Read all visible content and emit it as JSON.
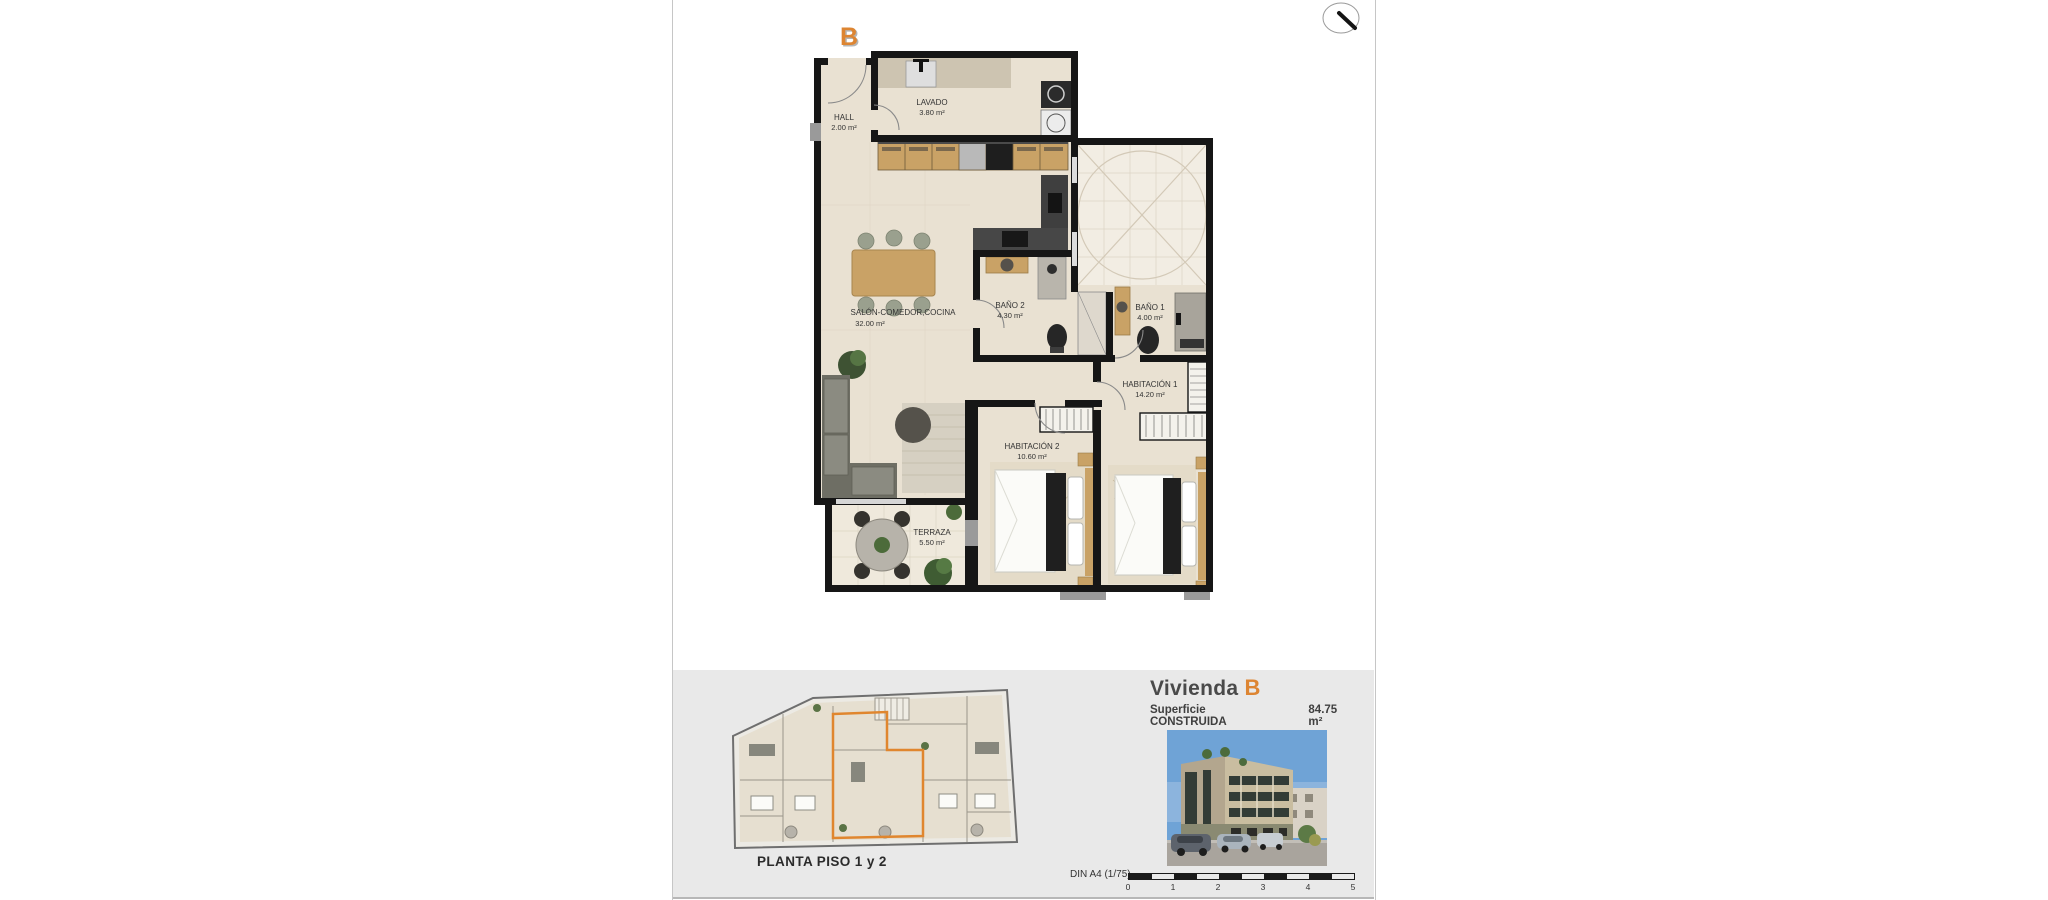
{
  "unit": {
    "letter": "B"
  },
  "header": {
    "title_prefix": "Vivienda",
    "surface_label": "Superficie CONSTRUIDA",
    "surface_value": "84.75 m²"
  },
  "overview": {
    "title": "PLANTA PISO 1 y 2"
  },
  "scale": {
    "label": "DIN A4 (1/75)",
    "ticks": [
      "0",
      "1",
      "2",
      "3",
      "4",
      "5"
    ]
  },
  "rooms": [
    {
      "name": "HALL",
      "area": "2.00 m²"
    },
    {
      "name": "LAVADO",
      "area": "3.80 m²"
    },
    {
      "name": "SALÓN-COMEDOR,COCINA",
      "area": "32.00 m²"
    },
    {
      "name": "BAÑO 2",
      "area": "4.30 m²"
    },
    {
      "name": "BAÑO 1",
      "area": "4.00 m²"
    },
    {
      "name": "HABITACIÓN 1",
      "area": "14.20 m²"
    },
    {
      "name": "HABITACIÓN 2",
      "area": "10.60 m²"
    },
    {
      "name": "TERRAZA",
      "area": "5.50 m²"
    }
  ],
  "icons": {
    "north_arrow": "compass-needle"
  },
  "colors": {
    "accent_orange": "#dd8532",
    "wall_black": "#161616",
    "floor_beige": "#e9e1d2",
    "patio_cream": "#f2ede3",
    "wood": "#c9a266",
    "sofa_gray": "#80807a",
    "panel_gray": "#e9e9e9",
    "sky_blue": "#6fa3d6"
  }
}
